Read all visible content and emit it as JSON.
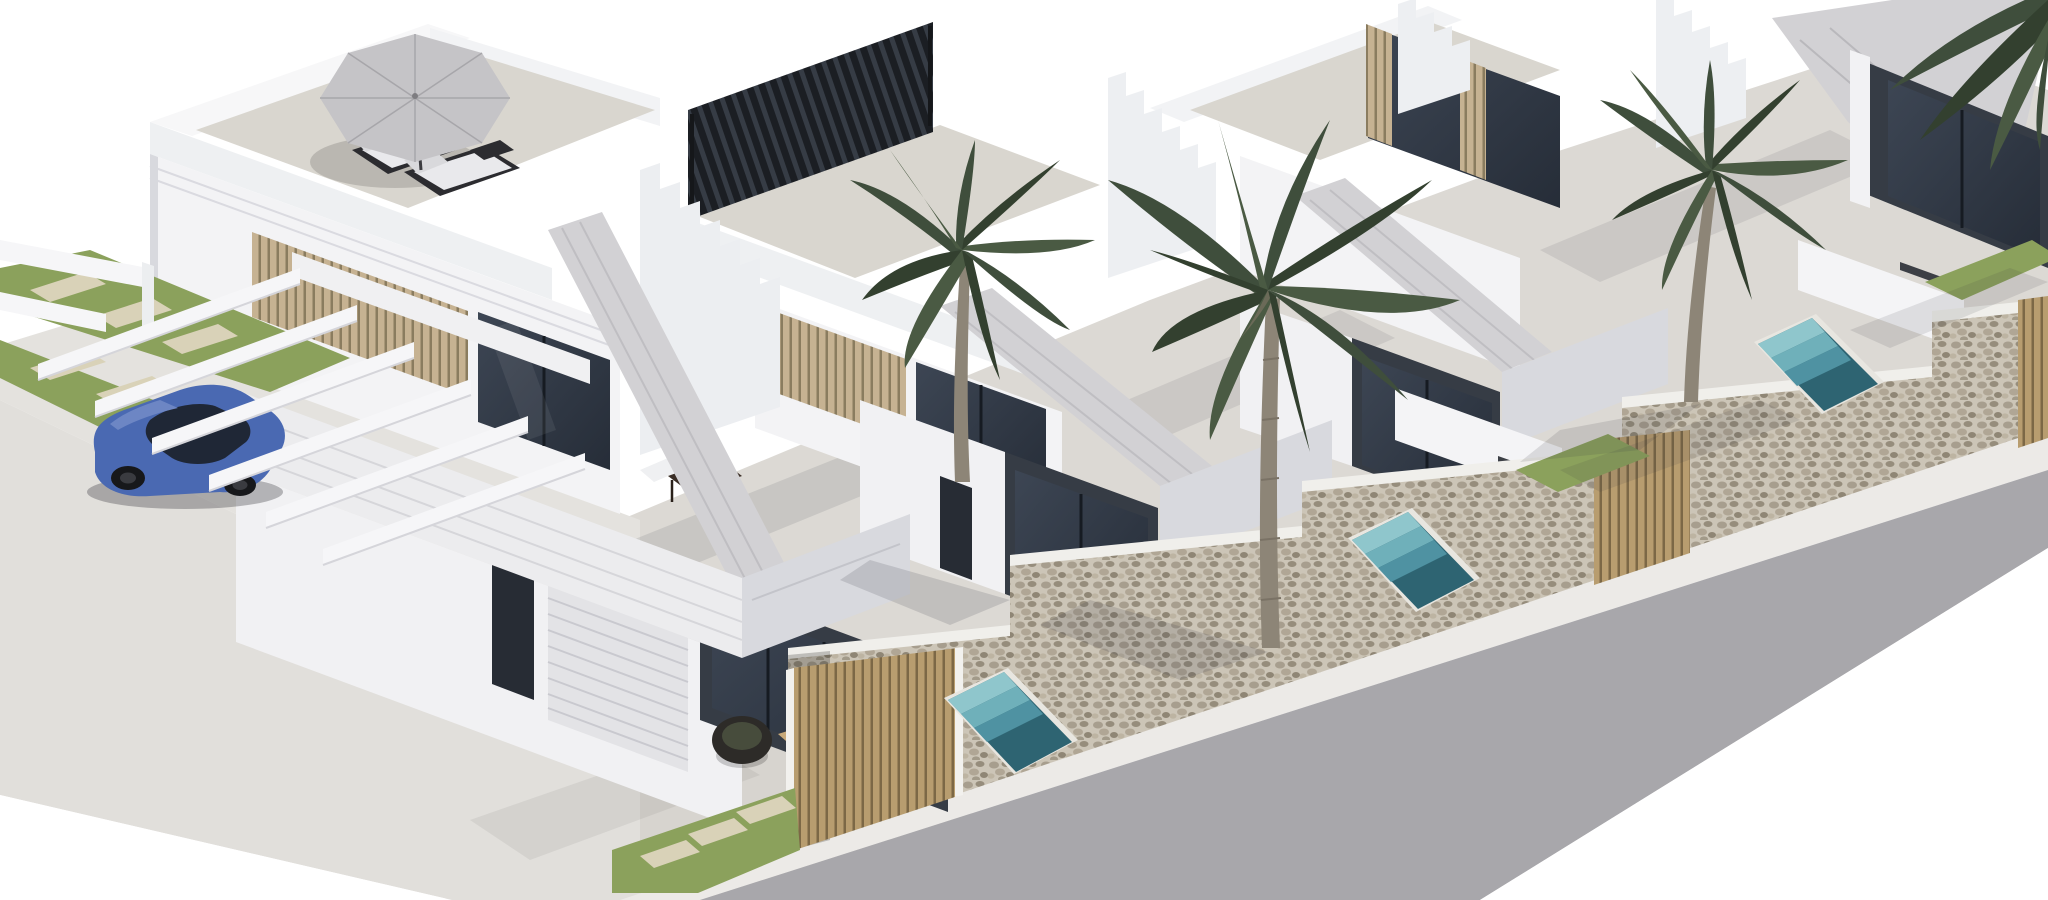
{
  "scene": {
    "type": "architectural-3d-render",
    "description": "Isometric exterior rendering of a row of identical modern white two-storey villas with rooftop terraces, angled fascia bands, plunge pools, palm trees, a stone perimeter wall with wooden slat gates, a carport pergola with a blue car, and a street running along the lower right",
    "objects": [
      "villa-1-front",
      "villa-2",
      "villa-3",
      "villa-4-partial",
      "roof-terrace-parasol",
      "sun-loungers",
      "rooftop-louver-pergola",
      "carport-pergola-beams",
      "blue-car",
      "palm-tree-a",
      "palm-tree-b",
      "palm-tree-c",
      "palm-fronds-corner",
      "stone-perimeter-wall",
      "wooden-gate-1",
      "wooden-gate-2",
      "wooden-gate-3",
      "plunge-pool-1",
      "plunge-pool-2",
      "plunge-pool-3",
      "grass-strips",
      "paver-slabs",
      "garage-door",
      "glass-doors",
      "wicker-chairs",
      "coffee-table",
      "balcony-table-set",
      "sidewalk",
      "road"
    ],
    "palette": {
      "background": "#ffffff",
      "wallLit": "#f3f3f5",
      "wallShade": "#d8d9de",
      "fascia": "#d2d1d4",
      "terraceFloor": "#d9d6cf",
      "yardPaving": "#dcd9d4",
      "ground": "#e4e2de",
      "glass": "#333b47",
      "glassFrame": "#1d232c",
      "slats": "#c6b292",
      "gateWood": "#b89d6f",
      "grass": "#8ba15c",
      "paver": "#d9d2b8",
      "stone": "#ccc5b7",
      "pool": "#2e6472",
      "poolStep": "#8fc6cc",
      "road": "#a8a7ab",
      "sidewalk": "#eceae7",
      "carBody": "#4a69b2",
      "carGlass": "#1f2736",
      "palmDark": "#3f4e3c",
      "palmMid": "#33402f",
      "palmLight": "#4a5a43",
      "trunk": "#8d8577",
      "parasol": "#c5c4c7",
      "louver": "#1b1e23",
      "furnitureDark": "#2c2c30",
      "cushion": "#e9e9ec",
      "woodTable": "#c8a97a",
      "shadow": "rgba(55,58,66,0.18)"
    }
  }
}
